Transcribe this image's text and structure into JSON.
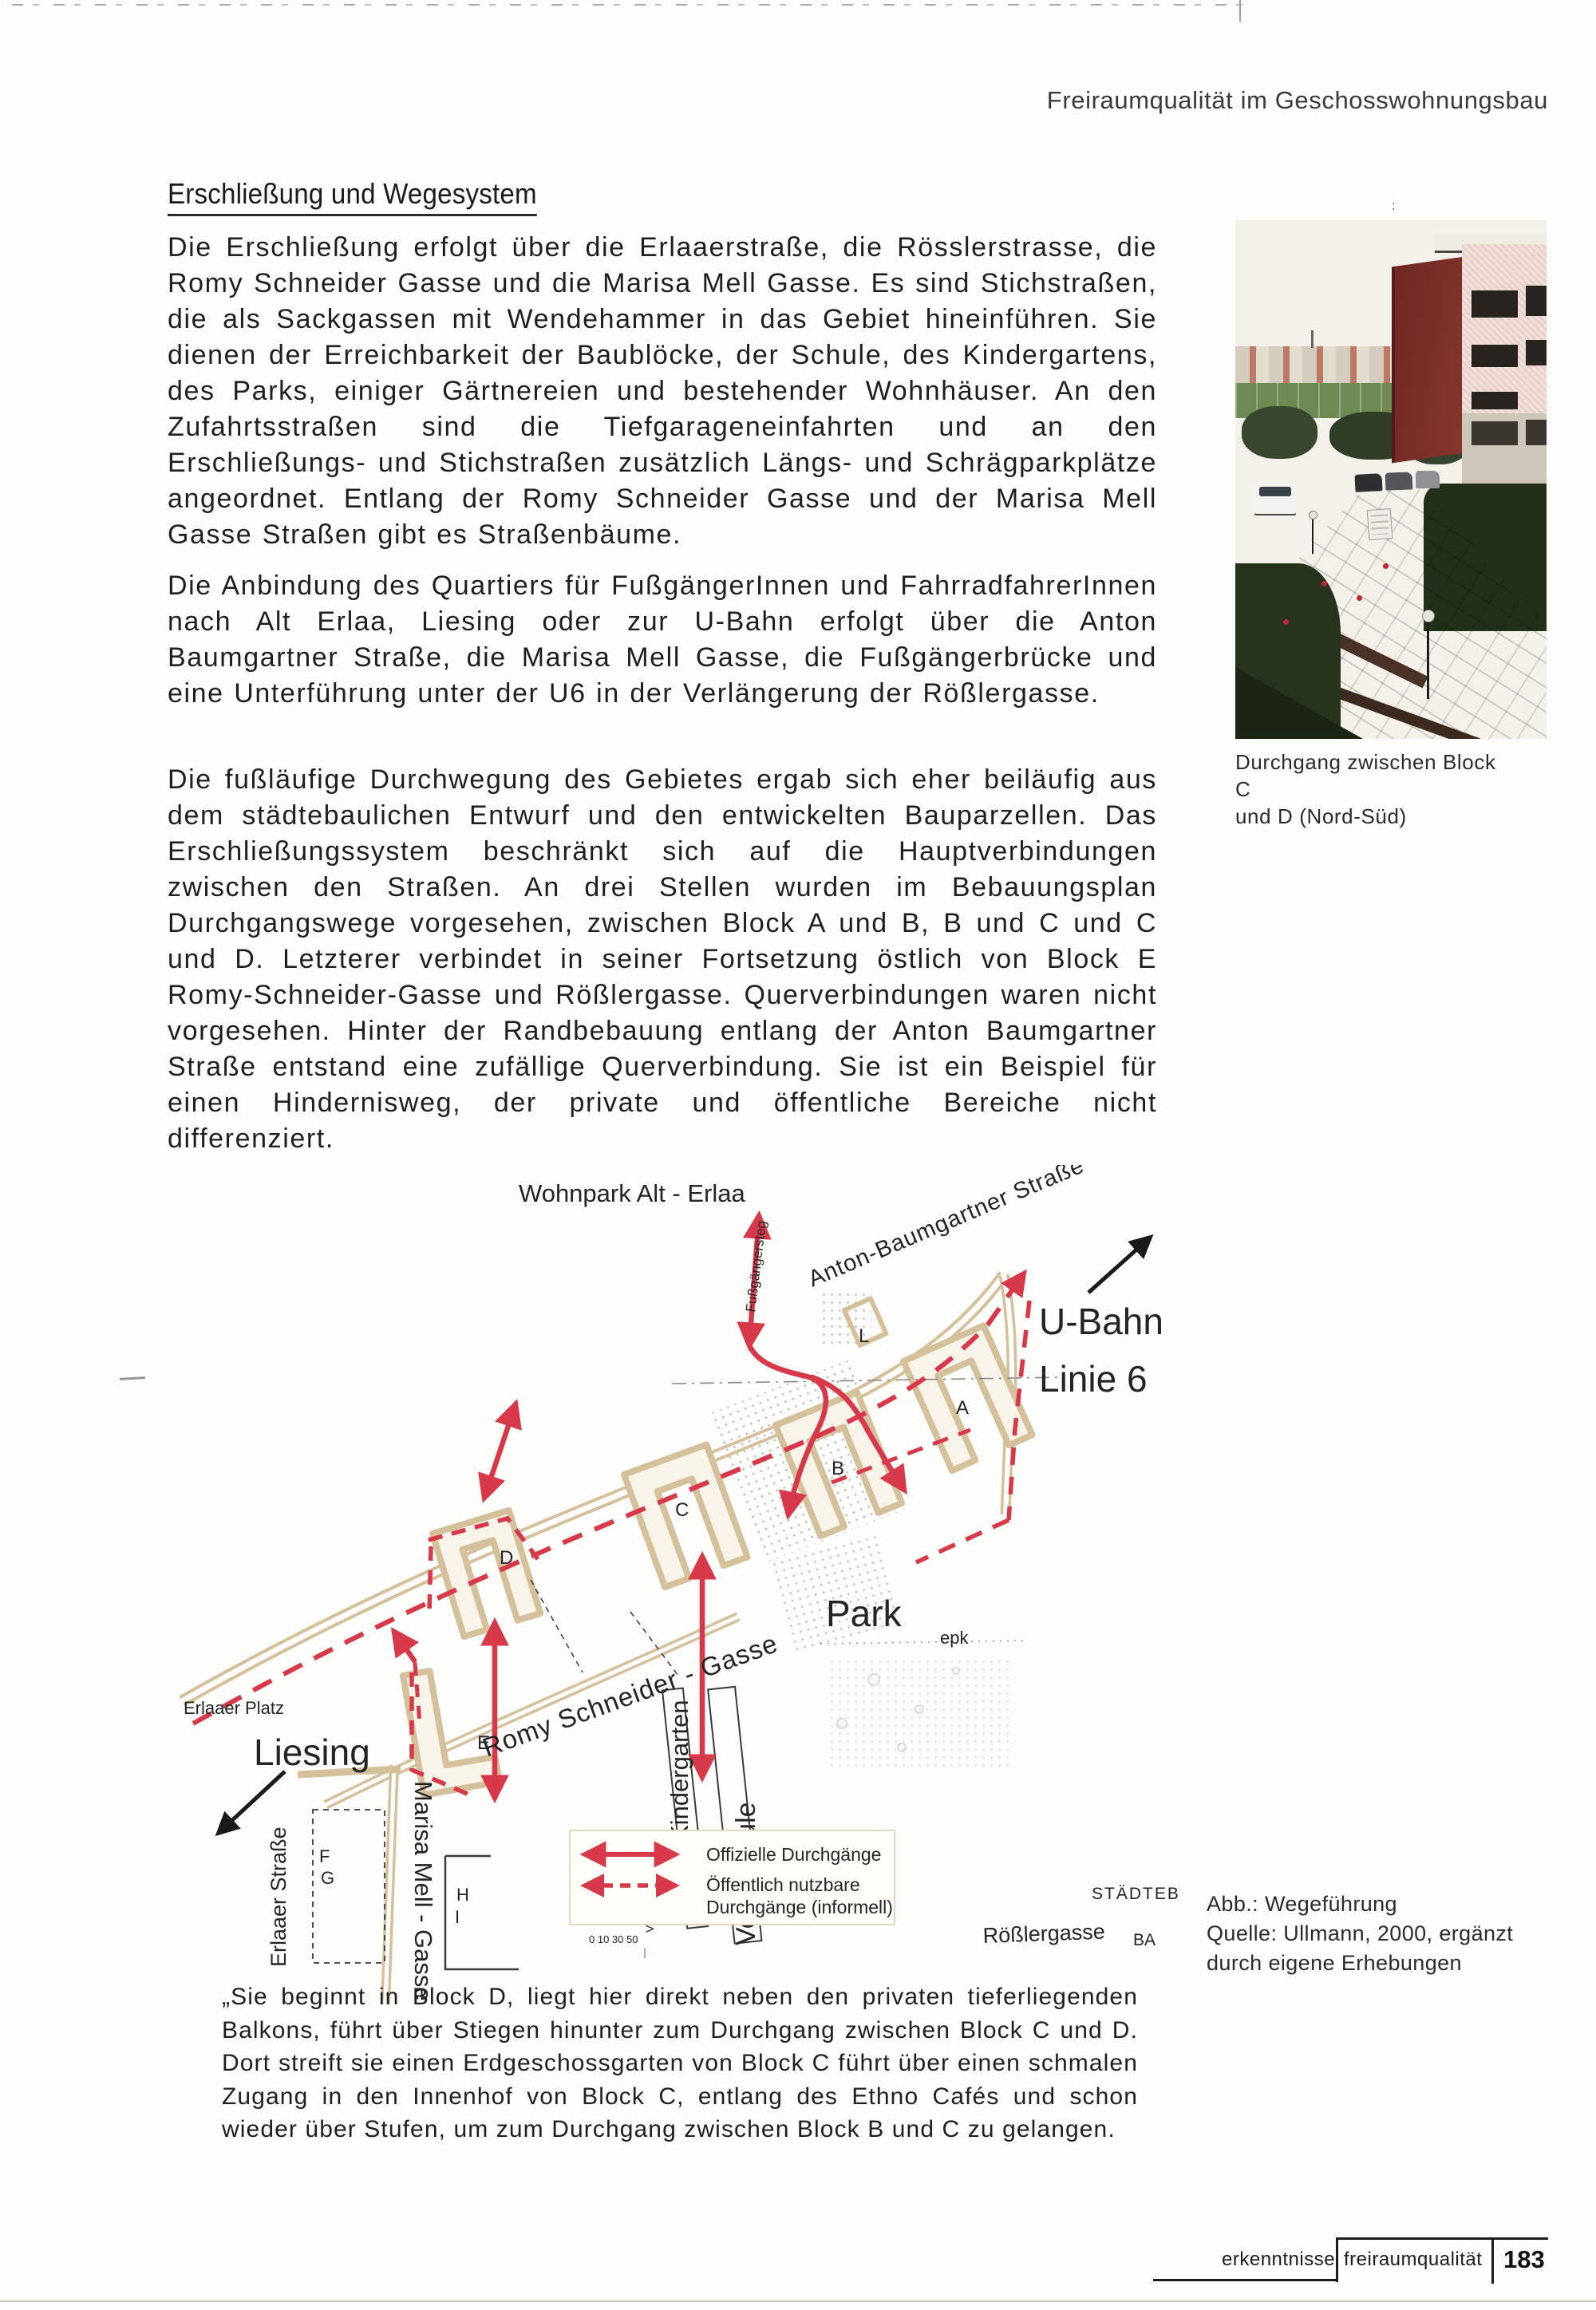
{
  "page": {
    "header": "Freiraumqualität im Geschosswohnungsbau",
    "heading": "Erschließung und Wegesystem",
    "paragraphs": [
      "Die Erschließung erfolgt über die Erlaaerstraße, die Rösslerstrasse, die Romy Schneider Gasse und die Marisa Mell Gasse. Es sind Stichstraßen, die als Sackgassen mit Wendehammer in das Gebiet hineinführen. Sie dienen der Erreichbarkeit der Baublöcke, der Schule, des Kindergartens, des Parks, einiger Gärtnereien und bestehender Wohnhäuser. An den Zufahrtsstraßen sind die Tiefgarageneinfahrten und an den Erschließungs- und Stichstraßen zusätzlich Längs- und Schrägparkplätze angeordnet. Entlang der Romy Schneider Gasse und der Marisa Mell Gasse Straßen gibt es Straßenbäume.",
      "Die Anbindung des Quartiers für FußgängerInnen und FahrradfahrerInnen nach Alt Erlaa, Liesing oder zur U-Bahn erfolgt über die Anton Baumgartner Straße, die Marisa Mell Gasse, die Fußgängerbrücke und eine Unterführung unter der U6 in der Verlängerung der Rößlergasse.",
      "Die fußläufige Durchwegung des Gebietes ergab sich eher beiläufig aus dem städtebaulichen Entwurf und den entwickelten Bauparzellen. Das Erschließungssystem beschränkt sich auf die Hauptverbindungen zwischen den Straßen. An drei Stellen wurden im Bebauungsplan Durchgangswege vorgesehen, zwischen Block A und B, B und C und C und D. Letzterer verbindet in seiner Fortsetzung östlich von Block E Romy-Schneider-Gasse und Rößlergasse. Querverbindungen waren nicht vorgesehen. Hinter der Randbebauung entlang der Anton Baumgartner Straße entstand eine zufällige Querverbindung. Sie ist ein Beispiel für einen Hindernisweg, der private und öffentliche Bereiche nicht differenziert."
    ],
    "photo": {
      "caption_line1": "Durchgang zwischen Block C",
      "caption_line2": "und D (Nord-Süd)"
    },
    "figure_caption": [
      "Abb.: Wegeführung",
      "Quelle: Ullmann, 2000, ergänzt",
      "durch eigene Erhebungen"
    ],
    "quote": "„Sie beginnt in Block D, liegt hier direkt neben den privaten tieferliegenden Balkons, führt über Stiegen hinunter zum Durchgang zwischen Block C und D. Dort streift sie einen Erdgeschossgarten von Block C führt über einen schmalen Zugang in den Innenhof von Block C, entlang des Ethno Cafés und schon wieder über Stufen, um zum Durchgang zwischen Block B und C zu gelangen.",
    "footer": {
      "section": "erkenntnisse",
      "chapter": "freiraumqualität",
      "page_number": "183"
    }
  },
  "map": {
    "labels": {
      "wohnpark": "Wohnpark Alt - Erlaa",
      "fussgaengersteg": "Fußgängersteg",
      "anton_baumgartner": "Anton-Baumgartner Straße",
      "ubahn": "U-Bahn",
      "linie6": "Linie 6",
      "park": "Park",
      "epk": "epk",
      "romy": "Romy Schneider - Gasse",
      "kindergarten": "Kindergarten",
      "volksschule_caps": "VOLKSSCHULE",
      "volksschule": "Volksschule",
      "roesslergasse": "Rößlergasse",
      "erlaaer_platz": "Erlaaer Platz",
      "liesing": "Liesing",
      "erlaaer_strasse": "Erlaaer Straße",
      "marisa": "Marisa Mell - Gasse",
      "staedteb": "STÄDTEB",
      "ba": "BA",
      "scale_ticks": "0  10    30     50"
    },
    "legend": {
      "official": "Offizielle Durchgänge",
      "informal_1": "Öffentlich nutzbare",
      "informal_2": "Durchgänge (informell)"
    },
    "blocks": [
      "A",
      "B",
      "C",
      "D",
      "E",
      "F",
      "G",
      "H",
      "I",
      "L"
    ]
  },
  "artifacts": {
    "colon": ":"
  },
  "colors": {
    "route_red": "#d8394a",
    "legend_red": "#d0303e",
    "street_tan": "#d4c09a",
    "building_maroon": "#7b2b26",
    "text_black": "#1f1f1f"
  }
}
